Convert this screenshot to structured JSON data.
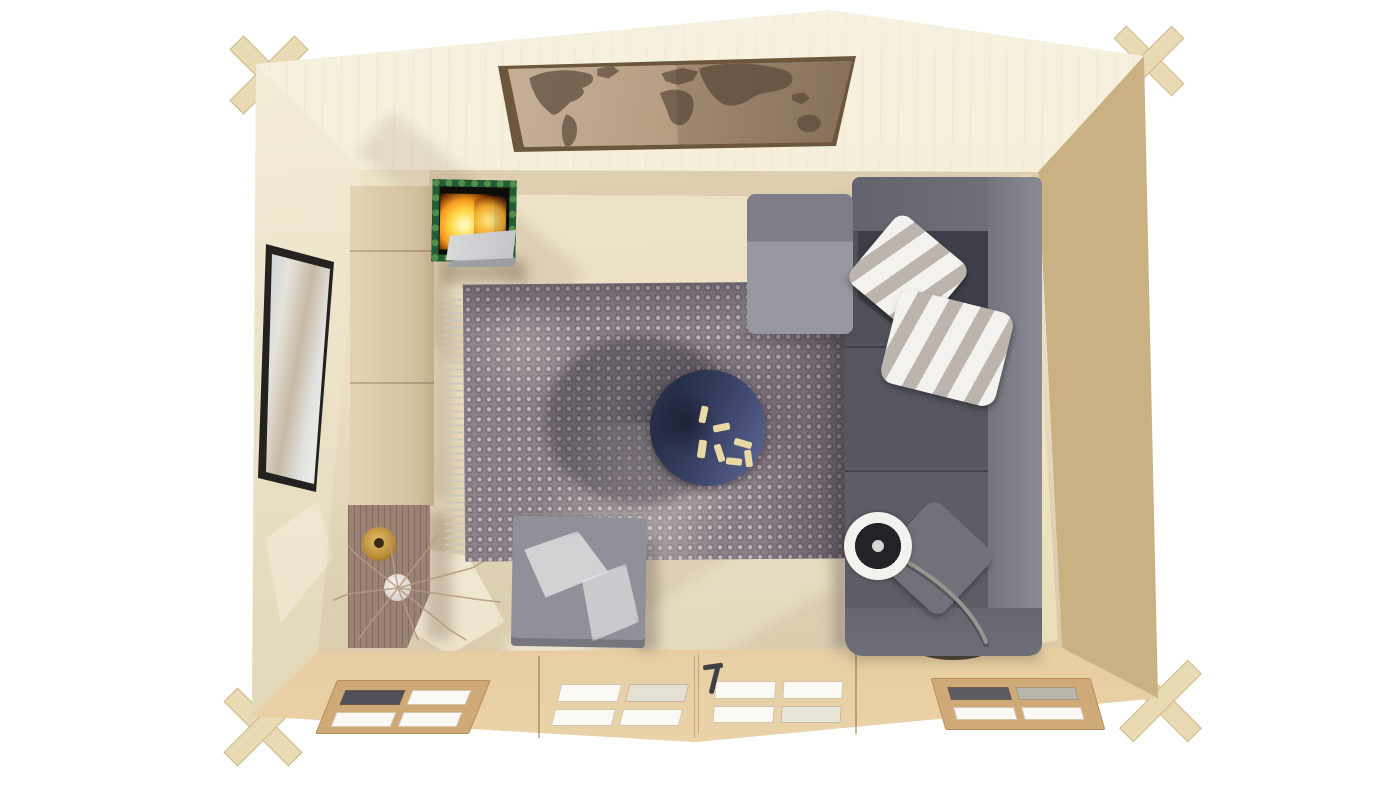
{
  "scene": {
    "name": "top-down-3d-render-of-log-cabin-garden-room-interior",
    "background": "#ffffff"
  },
  "palette": {
    "wall_top": "#f4edd6",
    "wall_left": "#efe6cd",
    "wall_right": "#c9b183",
    "wall_bottom": "#dcbf92",
    "floor": "#ebdfc3",
    "wood_joint": "#e8dab2",
    "cabinet": "#dccaa9",
    "sideboard": "#9c8274",
    "rug": "#8d8289",
    "rug_fringe": "#cdc6bc",
    "sofa": "#565661",
    "sofa_light": "#8f8f98",
    "sofa_dark": "#3e3e48",
    "sofa_arm": "#6e6e79",
    "pillow_gray": "#71717b",
    "coffee_table": "#3a4368",
    "game_piece": "#ead9a4",
    "ottoman": "#90909a",
    "lamp_shade": "#f4f2ee",
    "lamp_base": "#433d31",
    "stove_green": "#215c34",
    "fire_orange": "#f79a1e",
    "stove_panel": "#d3d4d6",
    "tv_frame": "#242220",
    "map_frame": "#6d573c",
    "map_glass": "#b49a7f",
    "map_land": "#6b5948",
    "vase_amber": "#c7993f",
    "vase_white": "#eceae4",
    "window_pane": "#fbf9f3",
    "window_surround": "#cfa977",
    "door_handle": "#3f3f46"
  },
  "objects": {
    "cabin": "log cabin shell seen from directly above, roof removed",
    "world_map_art": "world map picture on top wall",
    "tv": "wall mounted television on left wall",
    "log_burner": "wood burning stove with flames",
    "tall_cabinet": "pale wooden cabinet along left wall",
    "sideboard": "dark wood sideboard with vases",
    "branch_decor": "dry decorative branches in white vase",
    "rug": "mauve honeycomb patterned rug with fringe",
    "corner_sofa": "grey L-shaped corner sofa with chaise",
    "striped_pillows": "two white and grey striped cushions",
    "grey_pillow": "grey scatter cushion",
    "coffee_table": "round navy coffee table with game pieces",
    "ottoman": "square grey ottoman in sunlight",
    "arc_floor_lamp": "arc floor lamp with white drum shade",
    "double_door": "glazed double door in front wall",
    "window_left": "four pane window left of door",
    "window_right": "four pane window right of door",
    "corner_joints": "interlocking log corner joints"
  }
}
